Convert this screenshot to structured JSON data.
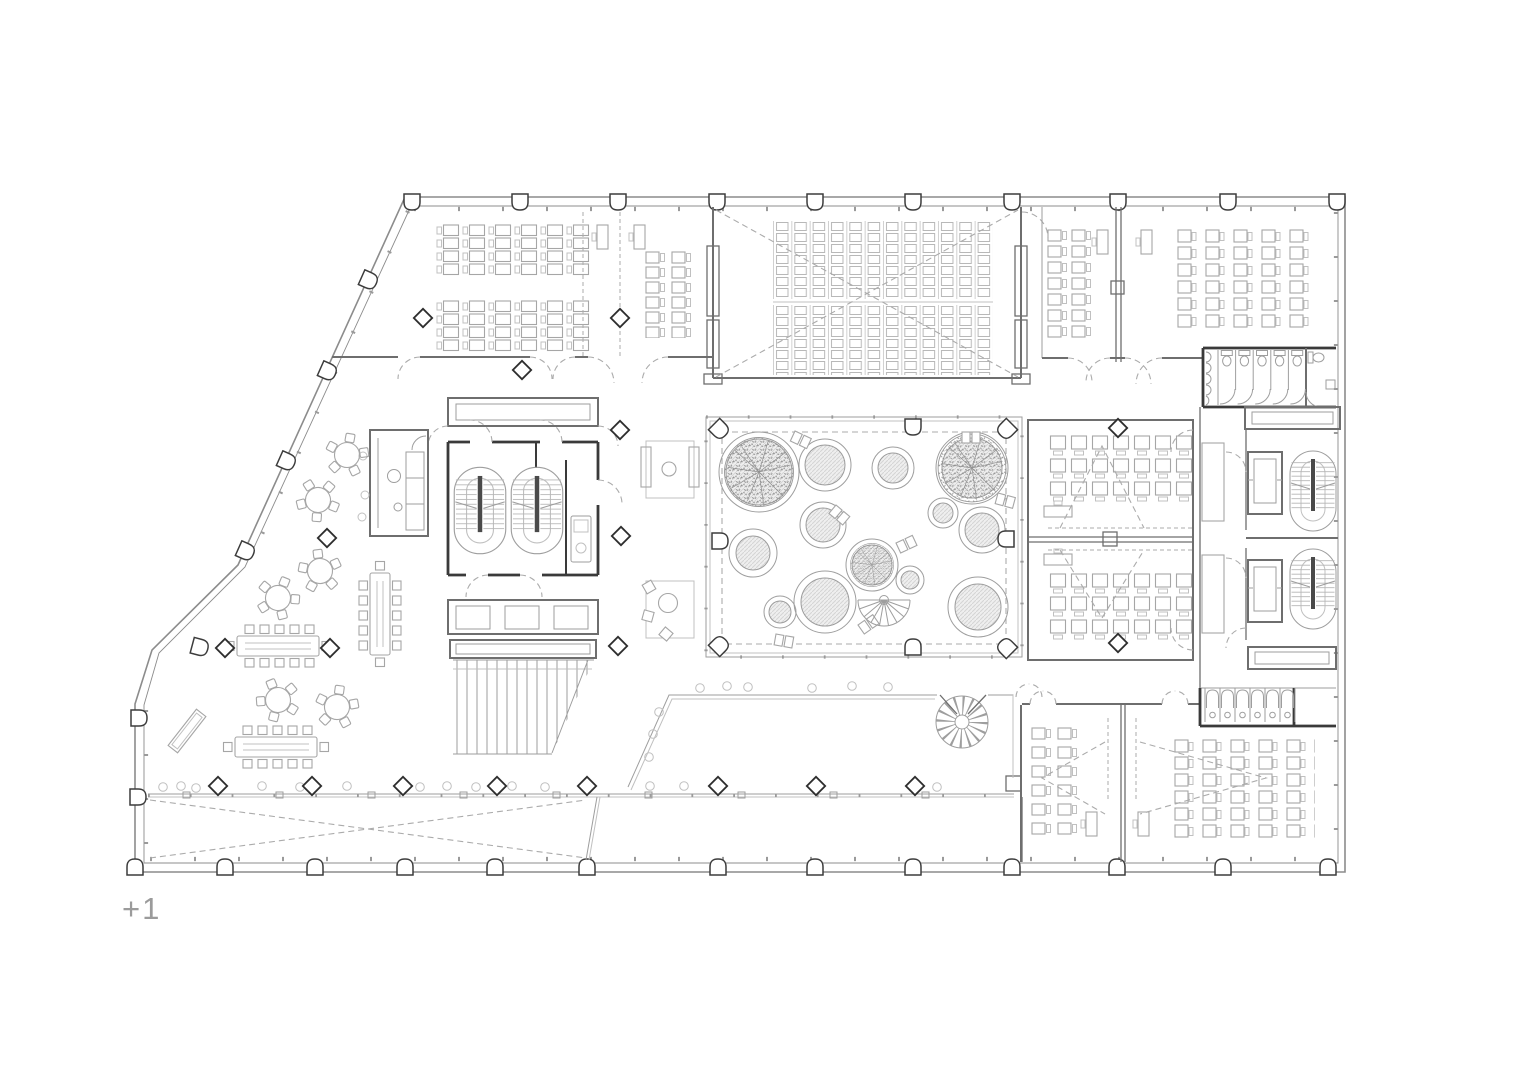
{
  "canvas": {
    "background": "#ffffff"
  },
  "floor": {
    "label": "+1"
  },
  "colors": {
    "background": "#ffffff",
    "facade": "#8c8c8c",
    "wall": "#6e6e6e",
    "wall_dark": "#3a3a3a",
    "furniture": "#a6a6a6",
    "furniture_light": "#c0c0c0",
    "thin": "#9e9e9e",
    "dashed": "#ababab",
    "hatch": "#d4d4d4",
    "hatch_bg": "#efefef",
    "tree": "#8f8f8f",
    "label": "#9b9b9b"
  },
  "symbols": {
    "facade_column_icon": "arched-column",
    "interior_column_icon": "diamond-column",
    "tree_icon": "tree-canopy",
    "planter_icon": "circular-planter",
    "spiral_stair_icon": "spiral-stair",
    "fan_stair_icon": "fan-stair",
    "stair_icon": "u-return-stair",
    "elevator_icon": "elevator-car",
    "door_icon": "swing-arc",
    "void_icon": "dashed-cross"
  }
}
